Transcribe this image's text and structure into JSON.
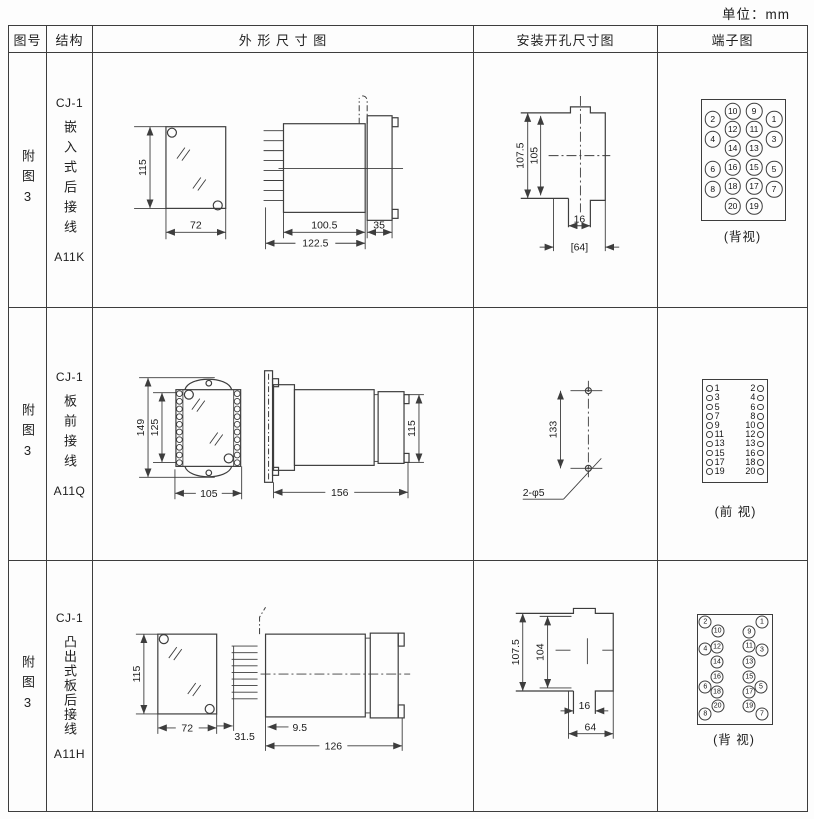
{
  "unit_label": "单位：mm",
  "header": {
    "fig_no": "图号",
    "structure": "结构",
    "outline": "外 形 尺 寸 图",
    "mounting": "安装开孔尺寸图",
    "terminal": "端子图"
  },
  "rows": [
    {
      "fig_no": "附图3",
      "structure": {
        "model": "CJ-1",
        "type": "嵌入式后接线",
        "code": "A11K"
      },
      "outline_dims": {
        "height": "115",
        "width": "72",
        "body_length": "100.5",
        "total_length": "122.5",
        "flange_width": "35"
      },
      "mounting_dims": {
        "height_outer": "107.5",
        "height_inner": "105",
        "slot_width": "16",
        "cutout_width": "[64]"
      },
      "terminal": {
        "view_label": "(背视)",
        "d": 14.5,
        "fs": 8.5,
        "circles": [
          {
            "n": "10",
            "x": 74.7,
            "y": 58
          },
          {
            "n": "9",
            "x": 96,
            "y": 58
          },
          {
            "n": "2",
            "x": 54.7,
            "y": 66
          },
          {
            "n": "1",
            "x": 116,
            "y": 66
          },
          {
            "n": "12",
            "x": 74.7,
            "y": 76
          },
          {
            "n": "11",
            "x": 96,
            "y": 76
          },
          {
            "n": "4",
            "x": 54.7,
            "y": 86
          },
          {
            "n": "3",
            "x": 116,
            "y": 86
          },
          {
            "n": "14",
            "x": 74.7,
            "y": 95
          },
          {
            "n": "13",
            "x": 96,
            "y": 95
          },
          {
            "n": "16",
            "x": 74.7,
            "y": 114
          },
          {
            "n": "15",
            "x": 96,
            "y": 114
          },
          {
            "n": "6",
            "x": 54.7,
            "y": 116
          },
          {
            "n": "5",
            "x": 116,
            "y": 116
          },
          {
            "n": "18",
            "x": 74.7,
            "y": 133
          },
          {
            "n": "17",
            "x": 96,
            "y": 133
          },
          {
            "n": "8",
            "x": 54.7,
            "y": 136
          },
          {
            "n": "7",
            "x": 116,
            "y": 136
          },
          {
            "n": "20",
            "x": 74.7,
            "y": 153
          },
          {
            "n": "19",
            "x": 96,
            "y": 153
          }
        ]
      }
    },
    {
      "fig_no": "附图3",
      "structure": {
        "model": "CJ-1",
        "type": "板前接线",
        "code": "A11Q"
      },
      "outline_dims": {
        "height": "149",
        "inner_height": "125",
        "width": "105",
        "total_length": "156",
        "rear_height": "115"
      },
      "mounting_dims": {
        "hole_spacing": "133",
        "hole_label": "2-φ5"
      },
      "terminal": {
        "view_label": "(前 视)",
        "rows": [
          {
            "l": "1",
            "r": "2"
          },
          {
            "l": "3",
            "r": "4"
          },
          {
            "l": "5",
            "r": "6"
          },
          {
            "l": "7",
            "r": "8"
          },
          {
            "l": "9",
            "r": "10"
          },
          {
            "l": "11",
            "r": "12"
          },
          {
            "l": "13",
            "r": "13"
          },
          {
            "l": "15",
            "r": "16"
          },
          {
            "l": "17",
            "r": "18"
          },
          {
            "l": "19",
            "r": "20"
          }
        ]
      }
    },
    {
      "fig_no": "附图3",
      "structure": {
        "model": "CJ-1",
        "type": "凸出式板后接线",
        "code": "A11H"
      },
      "outline_dims": {
        "height": "115",
        "width": "72",
        "pin_length": "31.5",
        "offset": "9.5",
        "total_length": "126"
      },
      "mounting_dims": {
        "height_outer": "107.5",
        "height_inner": "104",
        "slot_width": "16",
        "cutout_width": "64"
      },
      "terminal": {
        "view_label": "(背 视)",
        "d": 11,
        "fs": 7,
        "circles": [
          {
            "n": "2",
            "x": 47.3,
            "y": 61
          },
          {
            "n": "1",
            "x": 104,
            "y": 61
          },
          {
            "n": "10",
            "x": 59.7,
            "y": 70
          },
          {
            "n": "9",
            "x": 91.3,
            "y": 71
          },
          {
            "n": "12",
            "x": 59,
            "y": 86
          },
          {
            "n": "11",
            "x": 91.3,
            "y": 85
          },
          {
            "n": "4",
            "x": 47.3,
            "y": 88
          },
          {
            "n": "3",
            "x": 104,
            "y": 89
          },
          {
            "n": "14",
            "x": 59,
            "y": 101
          },
          {
            "n": "13",
            "x": 91.3,
            "y": 101
          },
          {
            "n": "16",
            "x": 59,
            "y": 116
          },
          {
            "n": "15",
            "x": 91.3,
            "y": 116
          },
          {
            "n": "6",
            "x": 47.3,
            "y": 126
          },
          {
            "n": "5",
            "x": 103,
            "y": 126
          },
          {
            "n": "18",
            "x": 59,
            "y": 131
          },
          {
            "n": "17",
            "x": 91.3,
            "y": 131
          },
          {
            "n": "20",
            "x": 59.7,
            "y": 145
          },
          {
            "n": "19",
            "x": 91.3,
            "y": 145
          },
          {
            "n": "8",
            "x": 47.3,
            "y": 153
          },
          {
            "n": "7",
            "x": 104,
            "y": 153
          }
        ]
      }
    }
  ]
}
